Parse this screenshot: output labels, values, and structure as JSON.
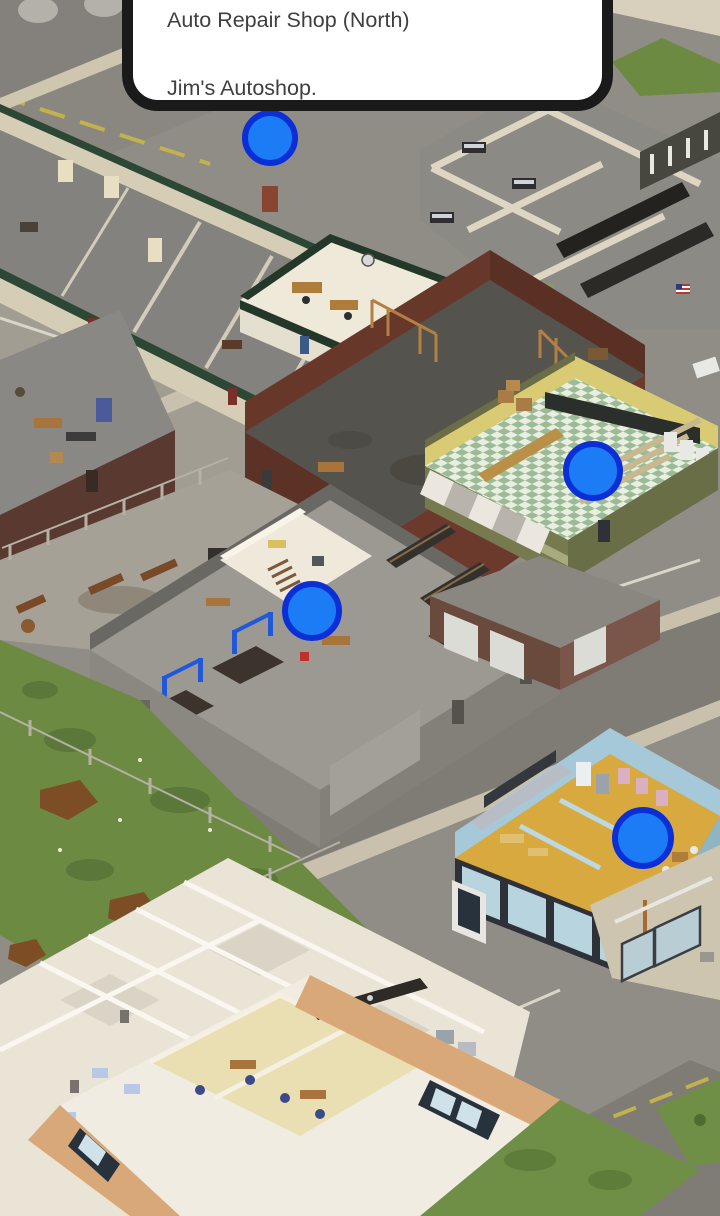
{
  "tooltip": {
    "line1": "Auto Repair Shop (North)",
    "line2": "Jim's Autoshop.",
    "bg_color": "#ffffff",
    "border_color": "#1a1a1a",
    "text_color": "#3f3f3f"
  },
  "markers": {
    "fill_color": "#1b7cf5",
    "ring_color": "#0b2fd6",
    "items": [
      {
        "x": 270,
        "y": 138,
        "r": 25
      },
      {
        "x": 593,
        "y": 471,
        "r": 27
      },
      {
        "x": 312,
        "y": 611,
        "r": 27
      },
      {
        "x": 643,
        "y": 838,
        "r": 28
      }
    ]
  }
}
